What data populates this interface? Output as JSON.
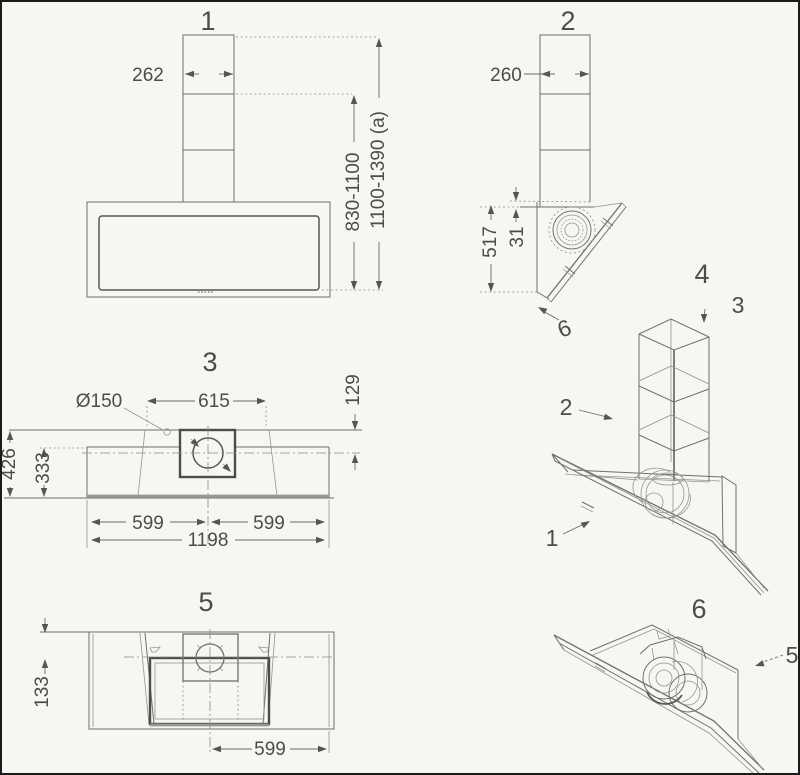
{
  "drawing": {
    "views": {
      "front": {
        "title": "1",
        "chimney_width": "262",
        "mount_height_a": "830-1100",
        "mount_height_b": "1100-1390 (a)"
      },
      "side": {
        "title": "2",
        "chimney_depth": "260",
        "body_height": "517",
        "top_offset": "31",
        "panel_callout": "6"
      },
      "top": {
        "title": "3",
        "duct_diameter": "Ø150",
        "duct_panel_width": "615",
        "duct_offset": "129",
        "depth_total": "426",
        "depth_inner": "333",
        "half_width_left": "599",
        "half_width_right": "599",
        "total_width": "1198"
      },
      "iso_assembly": {
        "title": "4",
        "callout_body": "1",
        "callout_chimney_lower": "2",
        "callout_chimney_upper": "3"
      },
      "bottom": {
        "title": "5",
        "edge_offset": "133",
        "half_width": "599"
      },
      "iso_body": {
        "title": "6",
        "callout_body": "5"
      }
    }
  }
}
